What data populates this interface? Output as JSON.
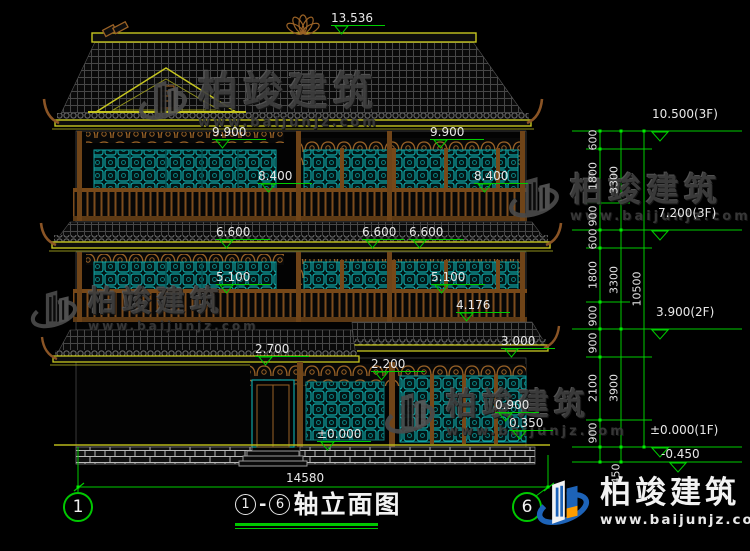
{
  "watermark": {
    "brand": "柏竣建筑",
    "site": "www.baijunjz.com"
  },
  "footer": {
    "axis_from": "1",
    "separator": "-",
    "axis_to": "6",
    "title": "轴立面图",
    "width_dim": "14580",
    "plinth_dim": "450"
  },
  "building_marks": [
    "13.536",
    "9.900",
    "9.900",
    "8.400",
    "8.400",
    "6.600",
    "6.600",
    "6.600",
    "5.100",
    "5.100",
    "4.176",
    "2.700",
    "3.000",
    "2.200",
    "±0.000",
    "0.900",
    "0.350"
  ],
  "right_levels": [
    "10.500(3F)",
    "7.200(3F)",
    "3.900(2F)",
    "±0.000(1F)",
    "-0.450"
  ],
  "right_chain": {
    "inner": [
      "600",
      "1800",
      "900",
      "600",
      "1800",
      "900",
      "900",
      "2100",
      "900"
    ],
    "mid": [
      "3300",
      "3300",
      "3900"
    ],
    "total": "10500"
  }
}
